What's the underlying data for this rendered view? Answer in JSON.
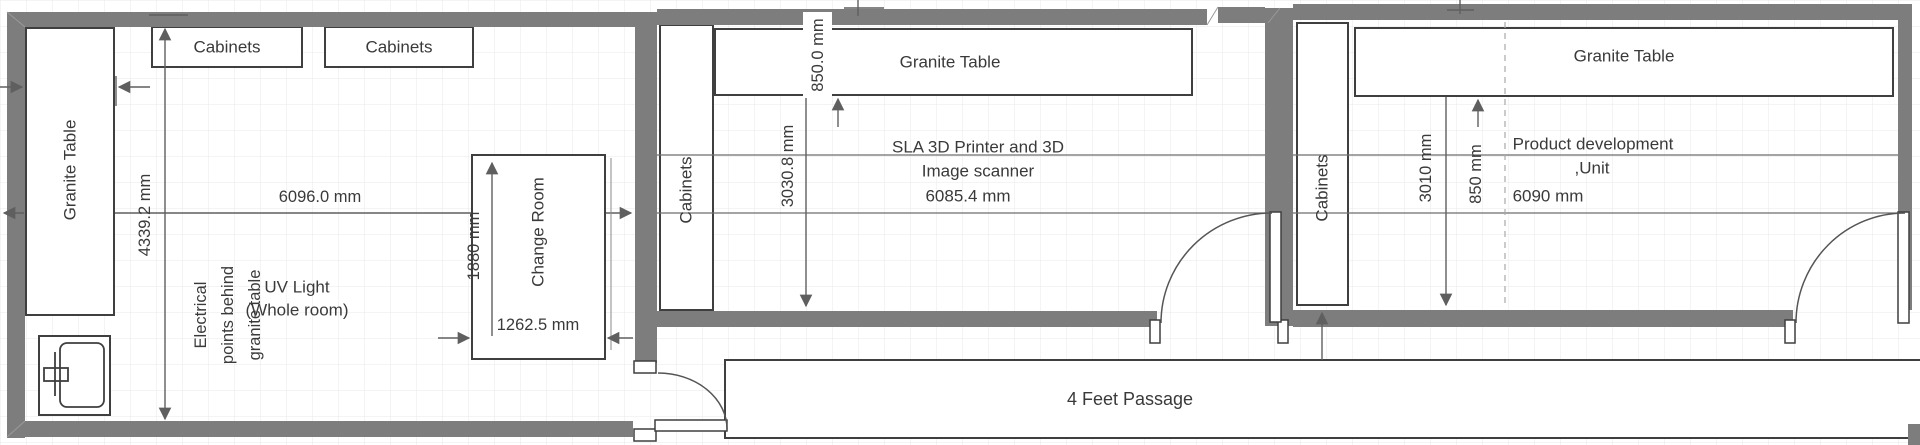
{
  "rooms": {
    "room1": {
      "granite_table_label": "Granite Table",
      "cabinets_left_label": "Cabinets",
      "cabinets_right_label": "Cabinets",
      "height_dim": "4339.2 mm",
      "width_dim": "6096.0 mm",
      "electrical_note": [
        "Electrical",
        "points behind",
        "granite table"
      ],
      "uv_note": [
        "UV Light",
        "(Whole room)"
      ],
      "change_room": {
        "label": "Change Room",
        "height_dim": "1880 mm",
        "width_dim": "1262.5 mm"
      }
    },
    "room2": {
      "granite_table_label": "Granite Table",
      "cabinets_label": "Cabinets",
      "table_offset_dim": "850.0 mm",
      "height_dim": "3030.8 mm",
      "equipment_note": [
        "SLA 3D Printer and 3D",
        "Image scanner",
        "6085.4 mm"
      ]
    },
    "room3": {
      "granite_table_label": "Granite Table",
      "cabinets_label": "Cabinets",
      "height_dim": "3010 mm",
      "table_offset_dim": "850 mm",
      "unit_note": [
        "Product development",
        ",Unit",
        "6090 mm"
      ]
    },
    "passage": {
      "label": "4 Feet Passage"
    },
    "colors": {
      "wall": "#7d7d7d",
      "box_border": "#3f3f3f",
      "dimension_line": "#5f5f5f",
      "text": "#3a3a3a",
      "grid": "#e9e9e9",
      "background": "#ffffff"
    }
  }
}
